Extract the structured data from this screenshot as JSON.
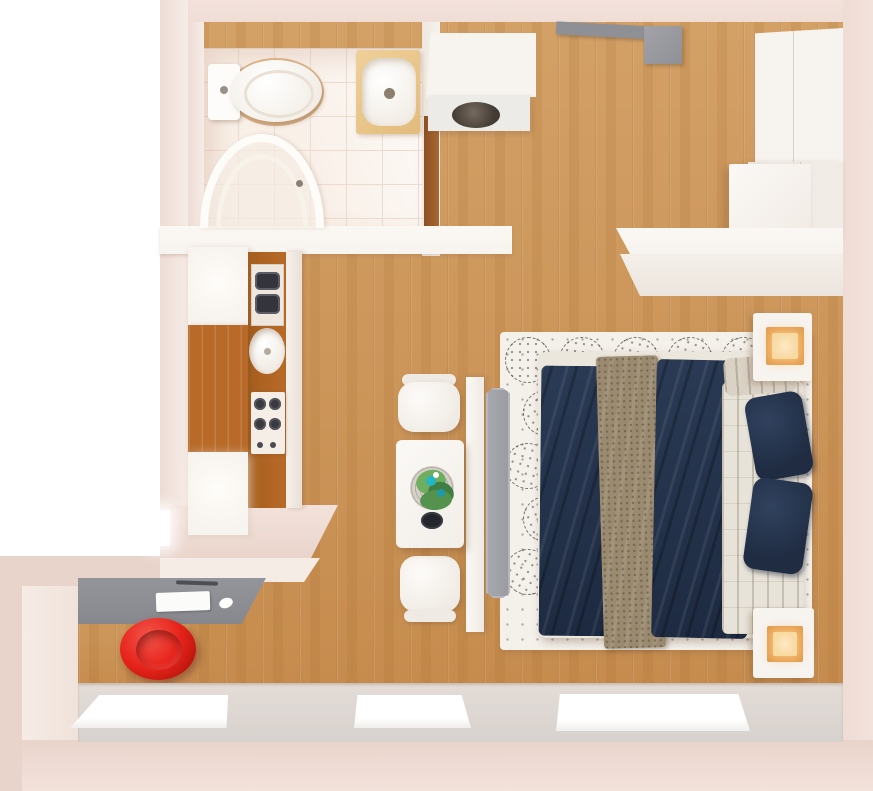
{
  "scene": {
    "type": "3d-floor-plan-render",
    "view": "top-down",
    "width": 873,
    "height": 791,
    "rooms": [
      "bathroom",
      "entrance-hall",
      "kitchen",
      "living-sleeping-area",
      "desk-nook"
    ]
  },
  "furniture": [
    "toilet",
    "bathroom-sink",
    "shower-cabin",
    "bathroom-door",
    "washing-machine-cabinet",
    "entrance-door",
    "wardrobe-upper",
    "wardrobe-lower",
    "fridge-cabinet",
    "sideboard",
    "kitchen-tall-cabinets",
    "kitchen-counter",
    "dish-rack",
    "kitchen-sink",
    "stove",
    "dining-table",
    "dining-chair-top",
    "dining-chair-bottom",
    "plant-vase",
    "black-plate",
    "tv-panel",
    "tv",
    "rug",
    "double-bed",
    "navy-duvet",
    "tan-blanket",
    "white-quilt",
    "pillows",
    "nightstand-with-lamp-top",
    "nightstand-with-lamp-bottom",
    "desk",
    "paper-sheet",
    "mouse",
    "red-chair",
    "window-1",
    "window-2",
    "window-3"
  ],
  "windows": {
    "count": 3
  },
  "lamps": {
    "count": 2,
    "glow": "amber"
  },
  "rug_pattern": {
    "cols": 6,
    "rows": 6,
    "step_x": 54,
    "step_y": 53,
    "size": 44,
    "inset": 5,
    "offset_alt": 18,
    "max_x": 306,
    "max_y": 312
  },
  "colors": {
    "outside": "#ffffff",
    "wallA": "#eedcd5",
    "wallB": "#f3e2db",
    "wallC": "#e9d4cb",
    "wallFace": "#f6ece6",
    "woodA": "#cc965a",
    "kwood": "#b96a28",
    "kwoodDark": "#a65e1e",
    "whiteFurn": "#f7f3ef",
    "tileBase": "#f9f0e8",
    "tileLine": "#ecdccf",
    "toiletShadow": "#dbb288",
    "sinkGold": "#e3bc7c",
    "doorWood": "#a9682f",
    "doorGray": "#8f9096",
    "navy": "#25334a",
    "navyDark": "#1f2c42",
    "tan": "#9a8a70",
    "quilt": "#e8e3d9",
    "rugBase": "#f4f0ea",
    "tvGray": "#9a9ca2",
    "tvFrame": "#b5b7bd",
    "placemat": "#d6d1c9",
    "greenA": "#55924e",
    "greenB": "#6fae5f",
    "greenC": "#3f7d43",
    "teal": "#24b6c4",
    "plate": "#24262b",
    "deskGray": "#87888d",
    "red": "#e6231b",
    "redDark": "#b8150d",
    "lampAmber": "#e29a4c",
    "lampGlow": "#f7d9a2",
    "sill": "#d8d2ce"
  }
}
